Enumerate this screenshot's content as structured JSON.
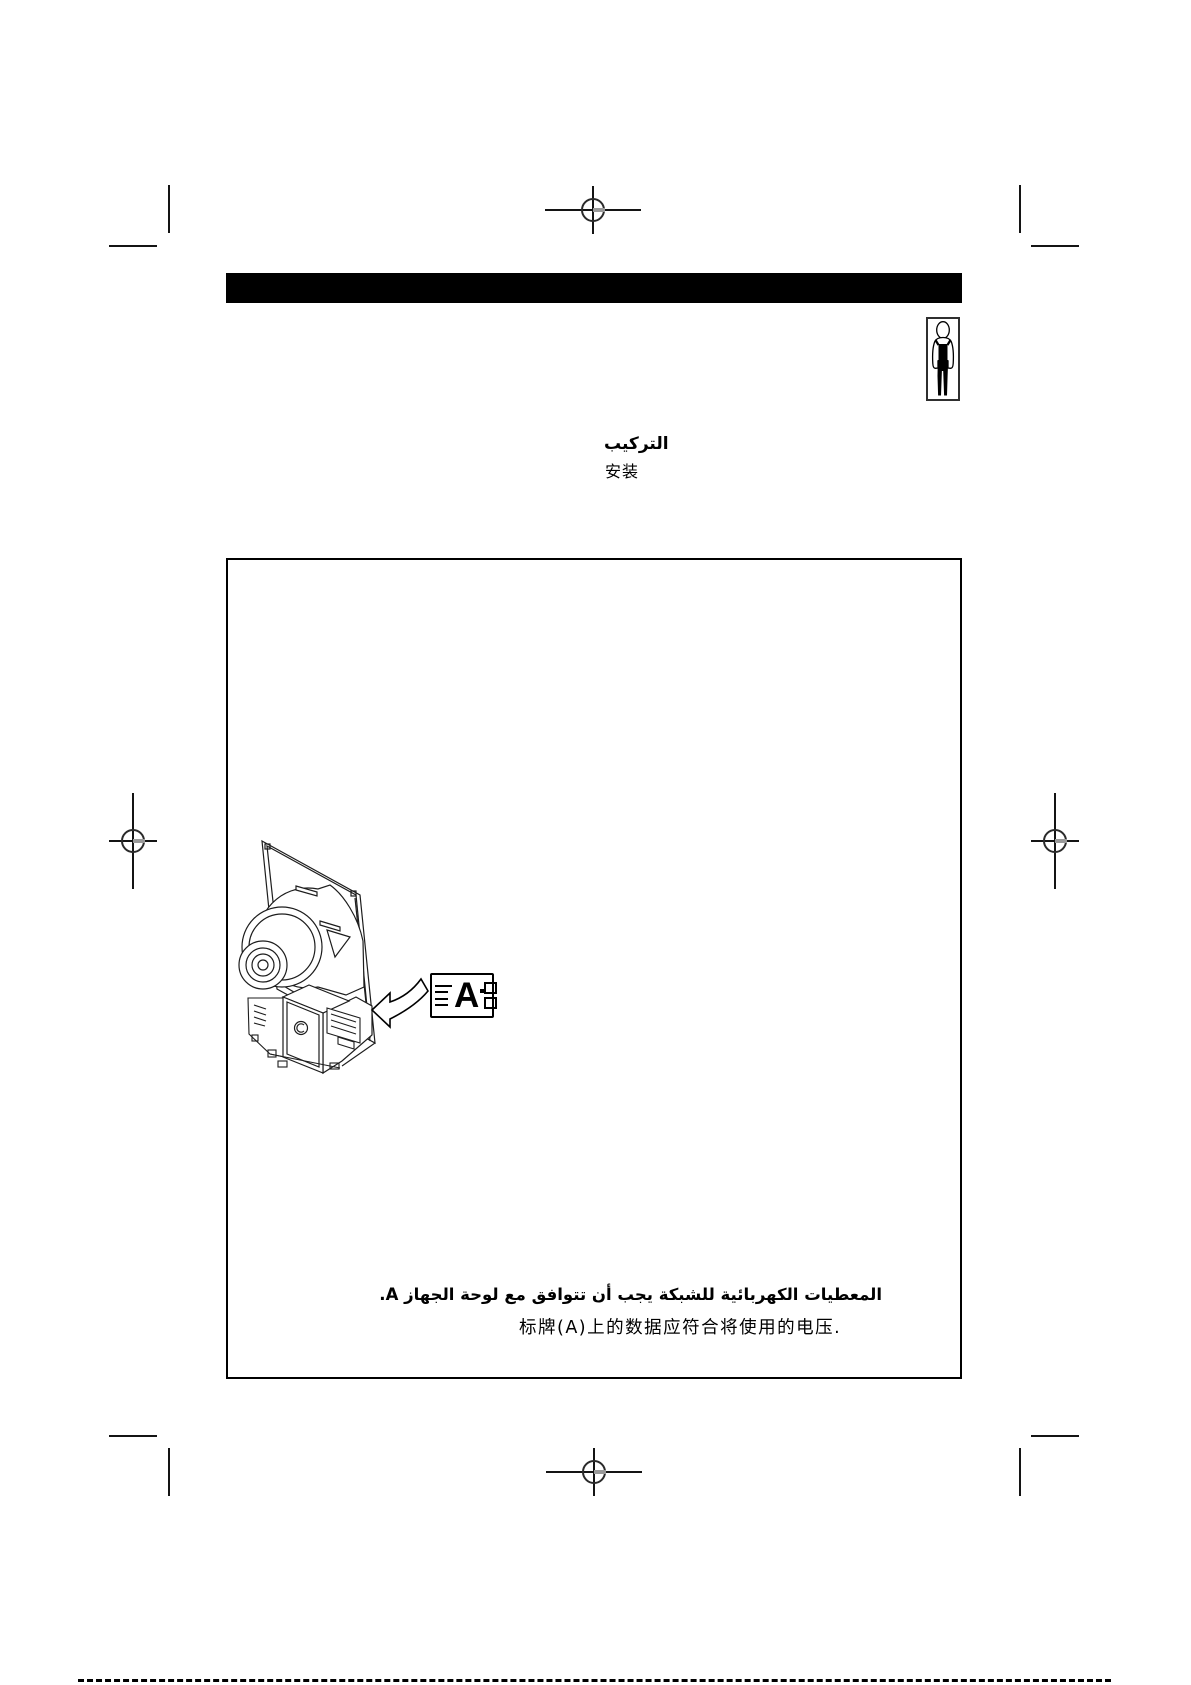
{
  "document": {
    "background_color": "#ffffff",
    "header_bar_color": "#000000"
  },
  "section_title": {
    "arabic": "التركيب",
    "chinese": "安装"
  },
  "figure": {
    "marker_label": "A"
  },
  "notes": {
    "arabic": "المعطيات الكهربائية للشبكة يجب أن تتوافق مع لوحة الجهاز A.",
    "chinese": "标牌(A)上的数据应符合将使用的电压."
  }
}
